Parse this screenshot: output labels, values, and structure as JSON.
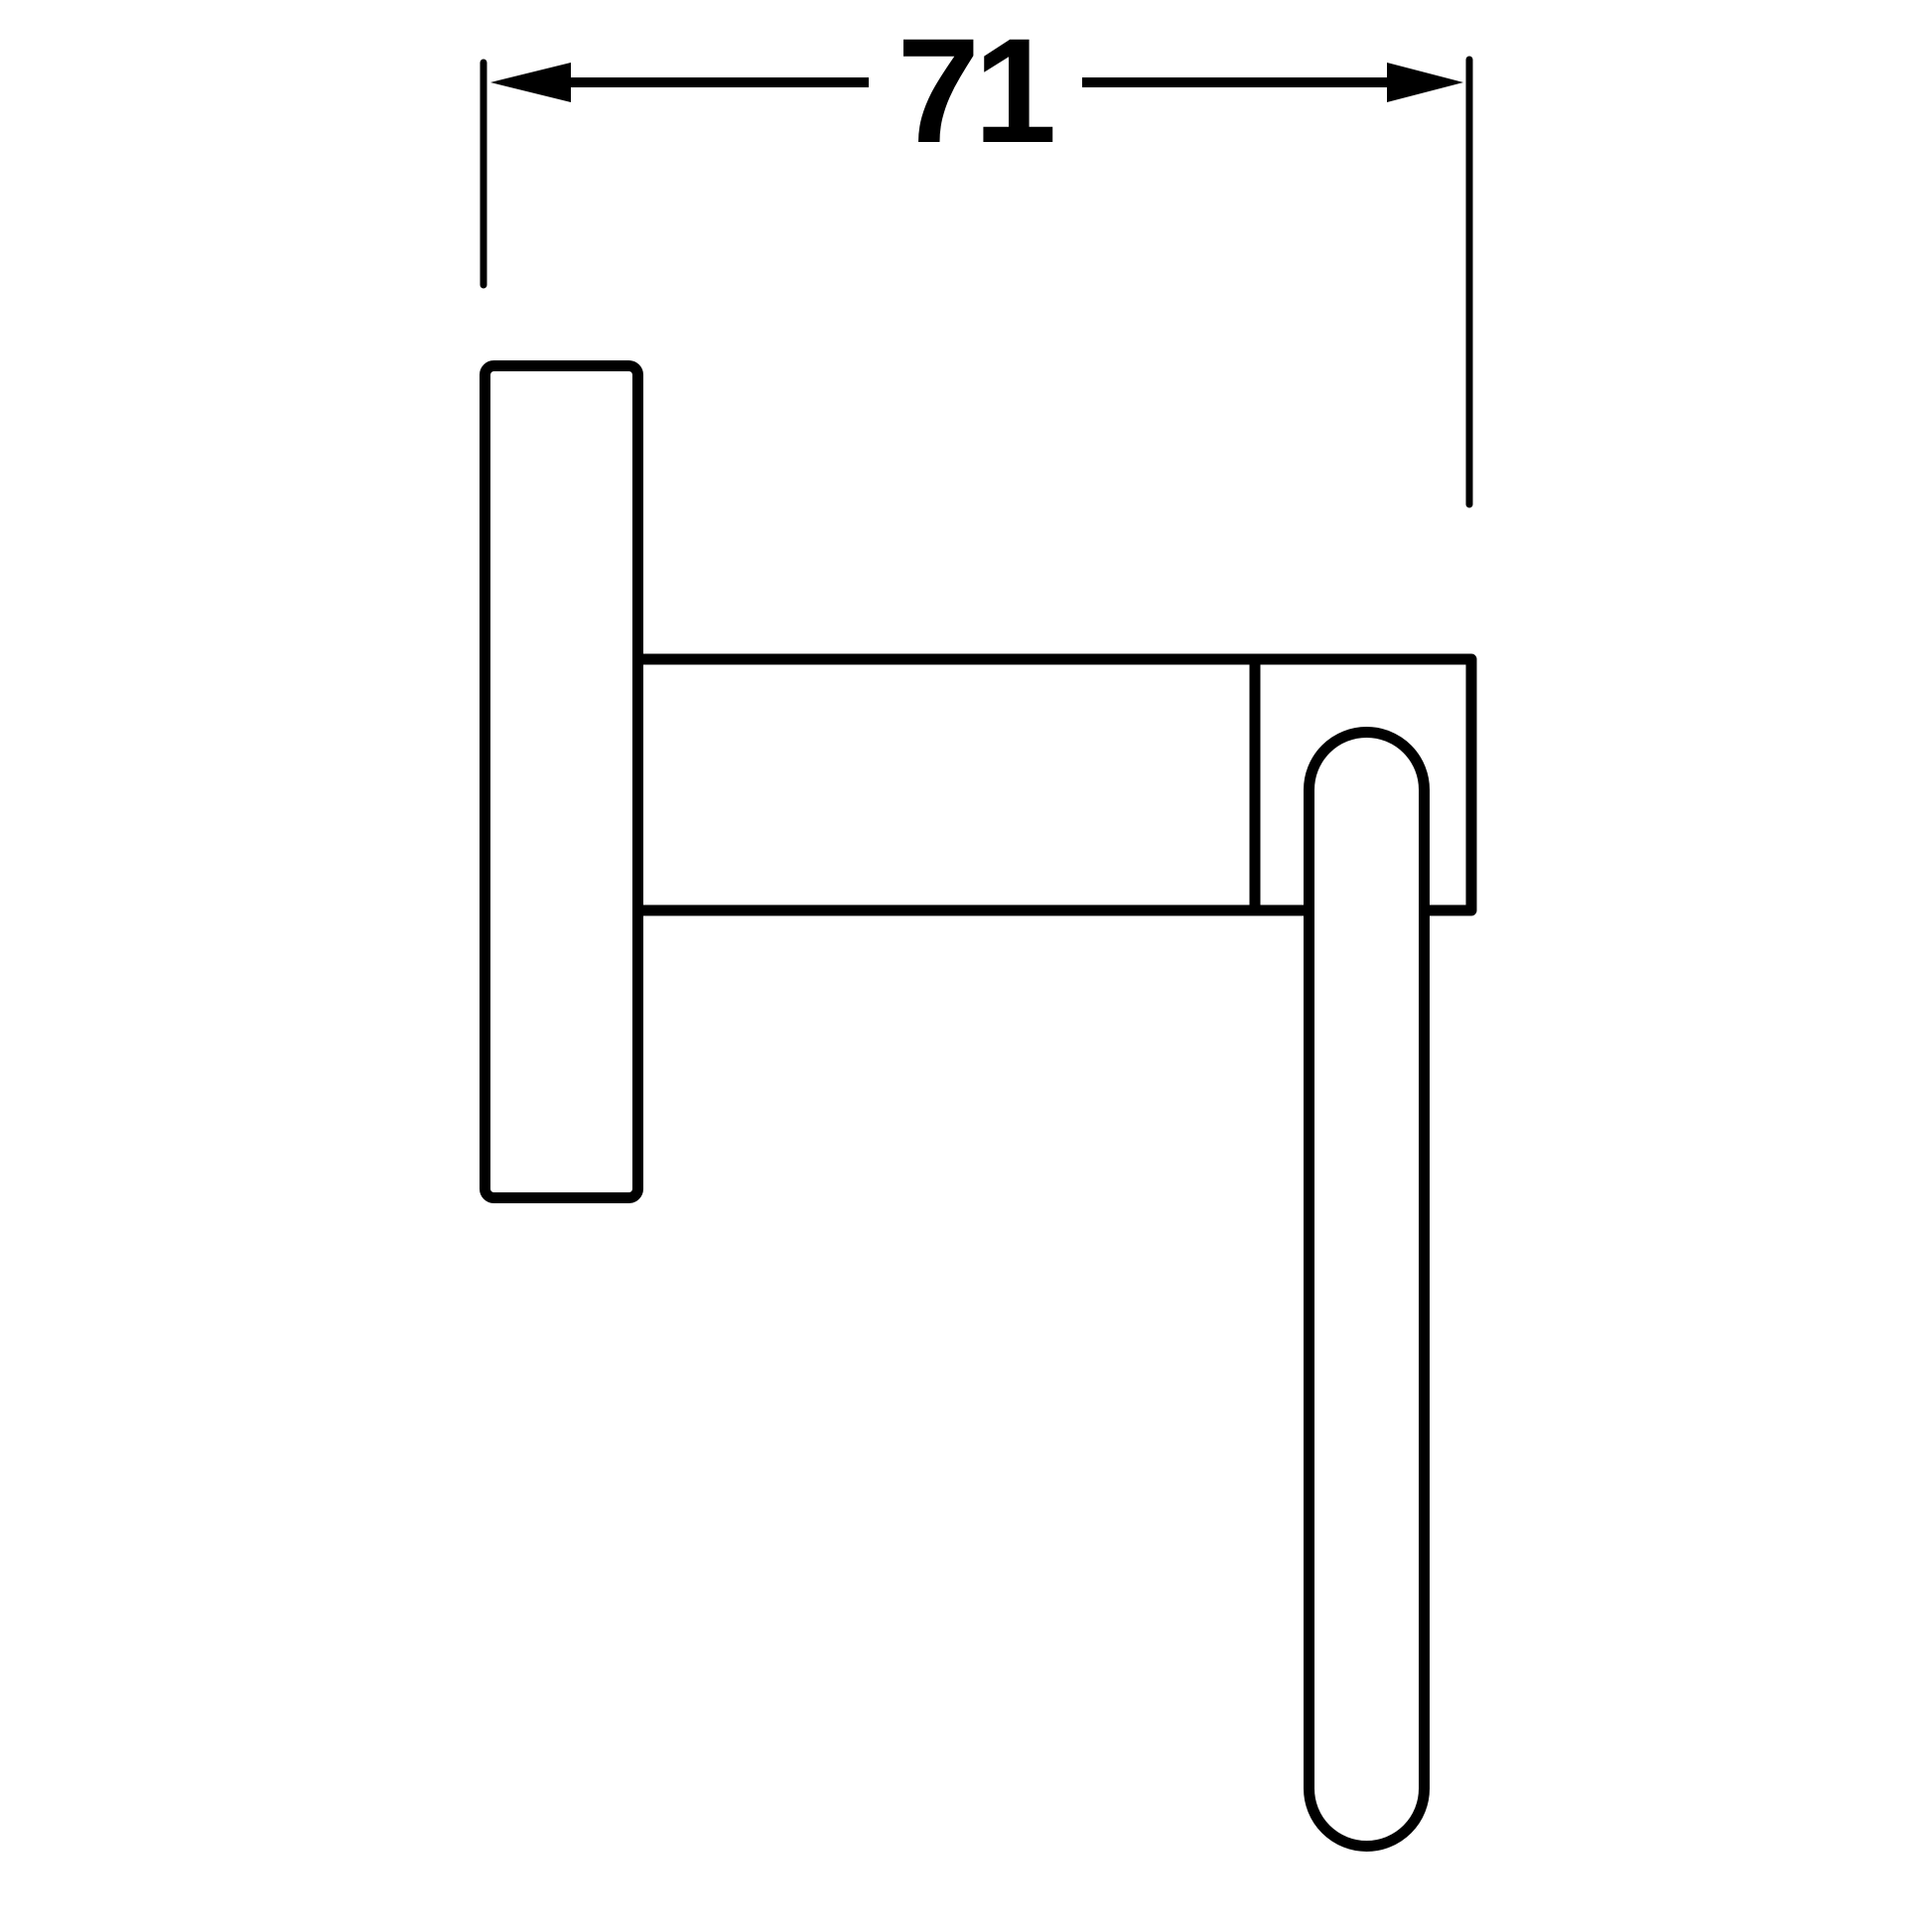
{
  "page": {
    "background_color": "#ffffff"
  },
  "drawing": {
    "description": "technical-dimension-drawing-side-view-wall-mounted-ring-fixture",
    "line_color": "#000000",
    "text_color": "#000000",
    "dimension": {
      "value": "71"
    }
  }
}
